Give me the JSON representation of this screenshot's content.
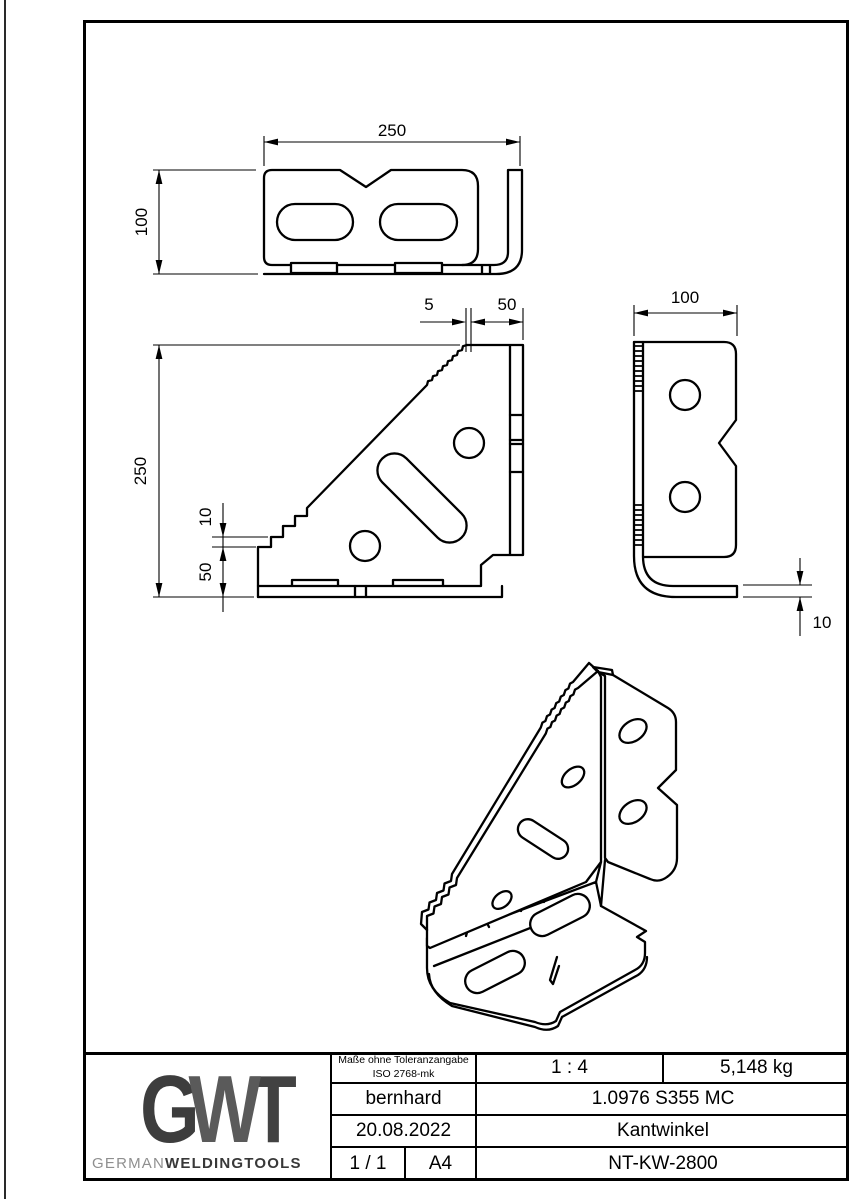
{
  "dimensions": {
    "top_view": {
      "length": "250",
      "depth": "100"
    },
    "front_view": {
      "height": "250",
      "pitch": "5",
      "flange_offset": "50",
      "step": "10",
      "base_height": "50"
    },
    "side_view": {
      "width": "100",
      "thickness": "10"
    }
  },
  "title_block": {
    "tolerance_note_line1": "Maße ohne Toleranzangabe",
    "tolerance_note_line2": "ISO 2768-mk",
    "scale": "1 : 4",
    "weight": "5,148 kg",
    "author": "bernhard",
    "material": "1.0976 S355 MC",
    "date": "20.08.2022",
    "part_name": "Kantwinkel",
    "sheet": "1 / 1",
    "paper_format": "A4",
    "drawing_number": "NT-KW-2800"
  },
  "logo": {
    "letter_g": "G",
    "letter_w": "W",
    "letter_t": "T",
    "brand_light": "GERMAN",
    "brand_bold": "WELDINGTOOLS"
  },
  "colors": {
    "line": "#000000",
    "logo_dark": "#3d3d3d",
    "logo_mid": "#5a5a5a",
    "brand_gray": "#8f8f8f"
  }
}
